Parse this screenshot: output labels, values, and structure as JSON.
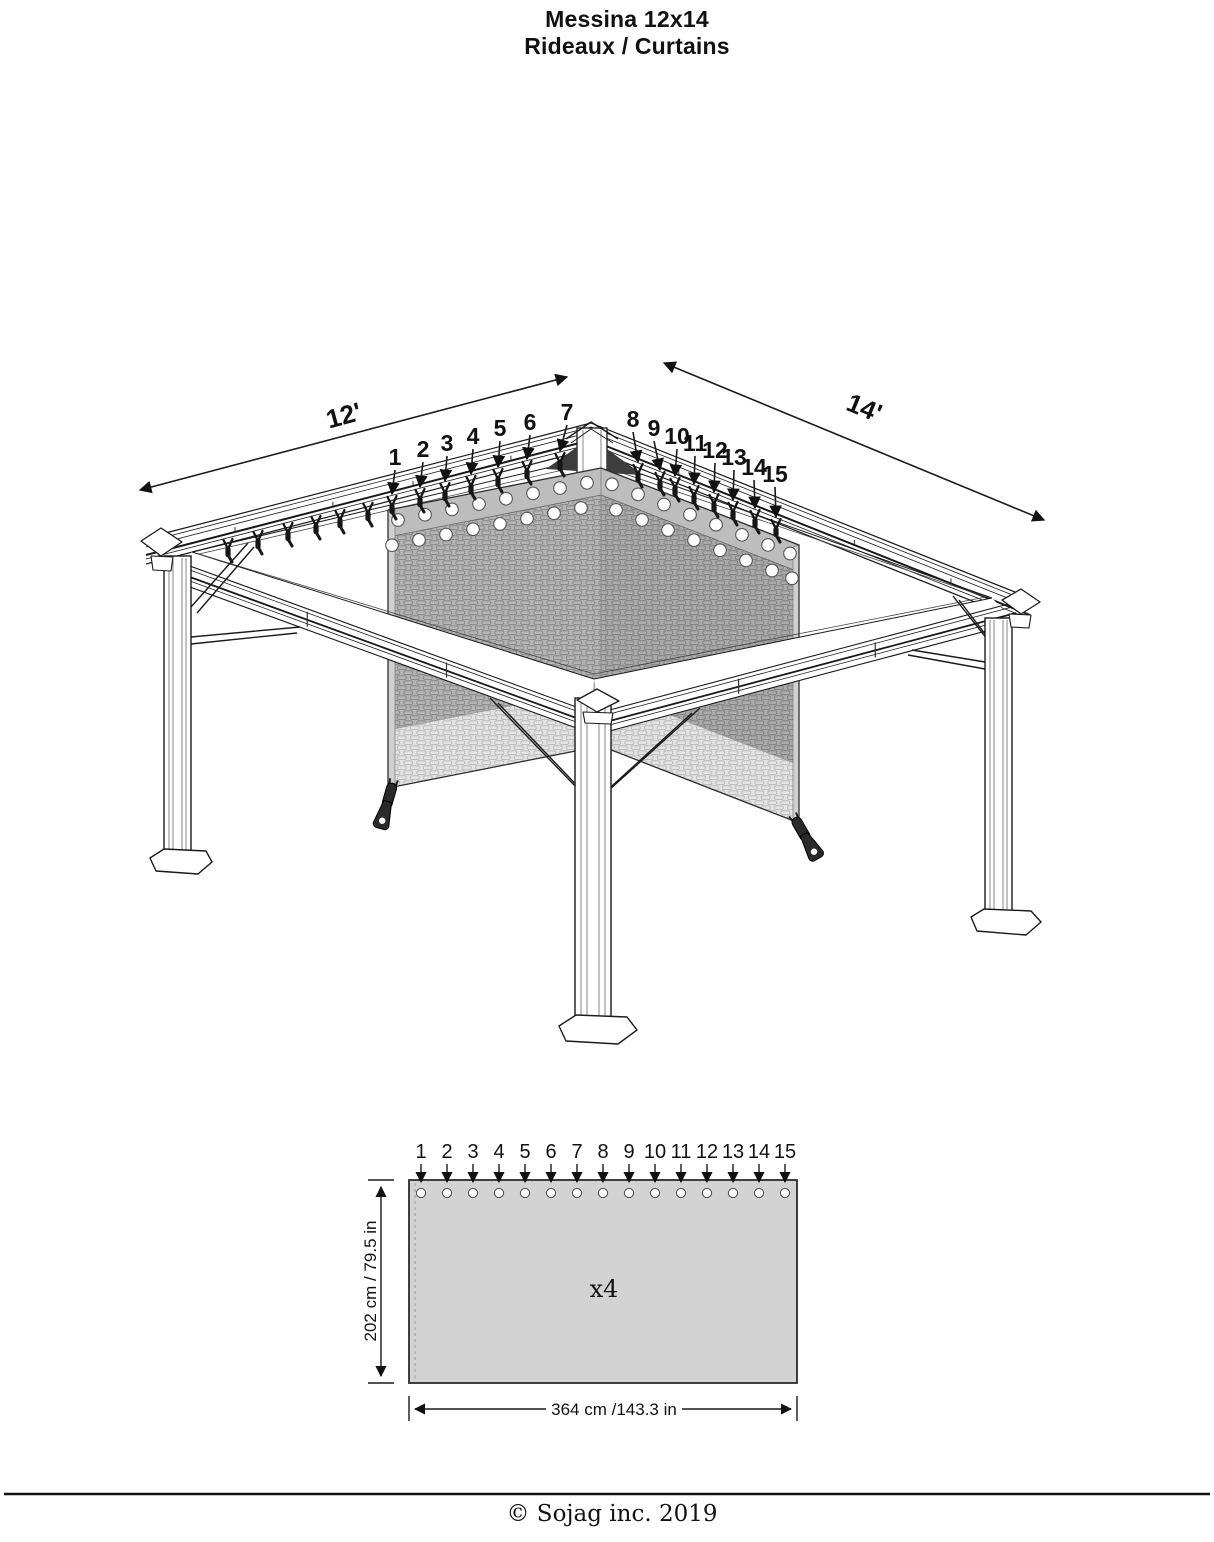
{
  "title": {
    "line1": "Messina 12x14",
    "line2": "Rideaux / Curtains"
  },
  "footer": {
    "copyright": "© Sojag inc. 2019"
  },
  "gazebo": {
    "width_label": "12'",
    "depth_label": "14'",
    "clip_numbers": [
      "1",
      "2",
      "3",
      "4",
      "5",
      "6",
      "7",
      "8",
      "9",
      "10",
      "11",
      "12",
      "13",
      "14",
      "15"
    ]
  },
  "curtain_panel": {
    "grommet_numbers": [
      "1",
      "2",
      "3",
      "4",
      "5",
      "6",
      "7",
      "8",
      "9",
      "10",
      "11",
      "12",
      "13",
      "14",
      "15"
    ],
    "quantity_label": "x4",
    "height_label": "202 cm / 79.5 in",
    "width_label": "364 cm /143.3 in"
  },
  "colors": {
    "ink": "#111111",
    "frame_line": "#1a1a1a",
    "curtain_fill": "#b4b4b4",
    "curtain_mesh_line": "#878787",
    "curtain_light_fill": "#e3e3e3",
    "curtain_light_mesh_line": "#b9b9b9",
    "band_fill": "#bdbdbd",
    "hem_fill": "#d0d0d0",
    "clip_color": "#161616",
    "gusset_color": "#3d3d3d",
    "flat_panel_fill": "#d3d3d3"
  }
}
